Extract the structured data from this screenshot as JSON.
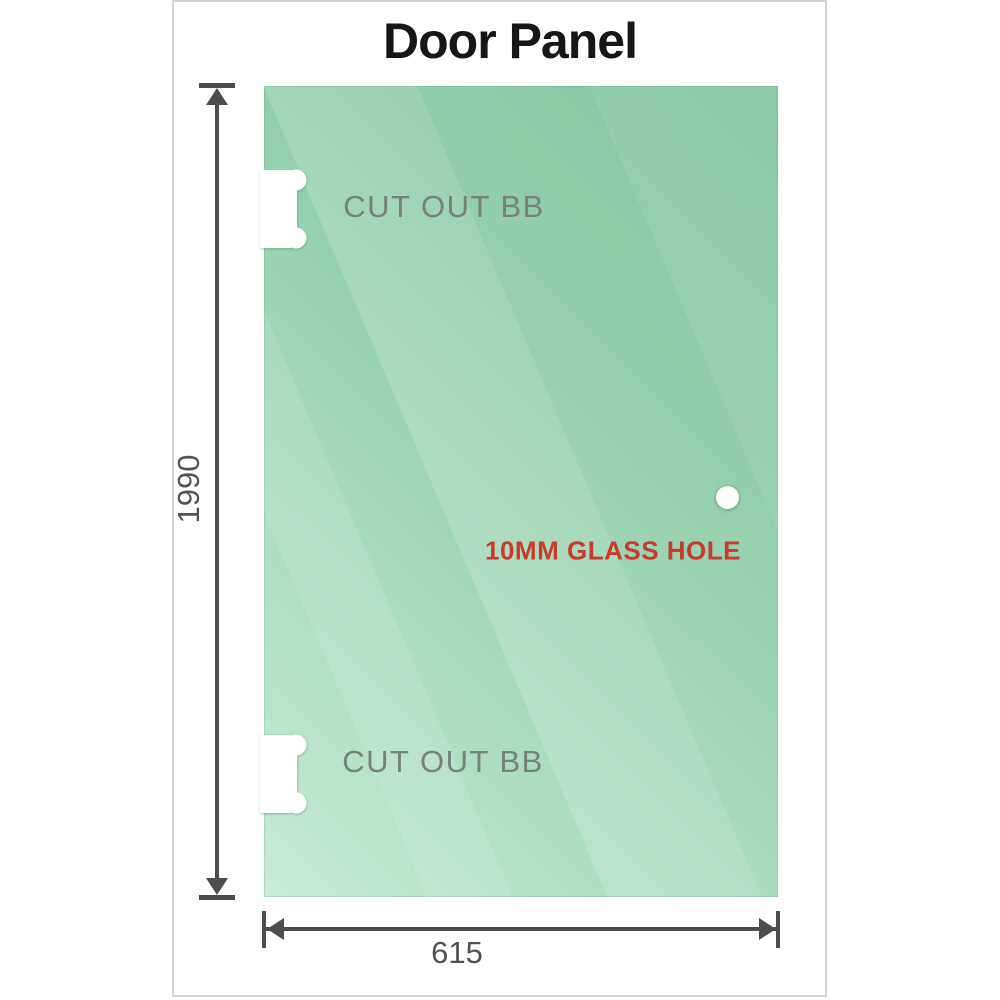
{
  "title": "Door Panel",
  "panel": {
    "cutouts": [
      {
        "label": "CUT OUT BB",
        "position": "top-left"
      },
      {
        "label": "CUT OUT BB",
        "position": "bottom-left"
      }
    ],
    "hole_label": "10MM GLASS HOLE"
  },
  "dims": {
    "height": "1990",
    "width": "615"
  },
  "colors": {
    "glass_green_dark": "#79c098",
    "glass_green_light": "#c8ecd7",
    "dimension_gray": "#4d4d4d",
    "hole_label_red": "#c63b2a",
    "cutout_label_gray": "#76817c",
    "frame_border": "#d2d2d2",
    "title_black": "#161616"
  }
}
